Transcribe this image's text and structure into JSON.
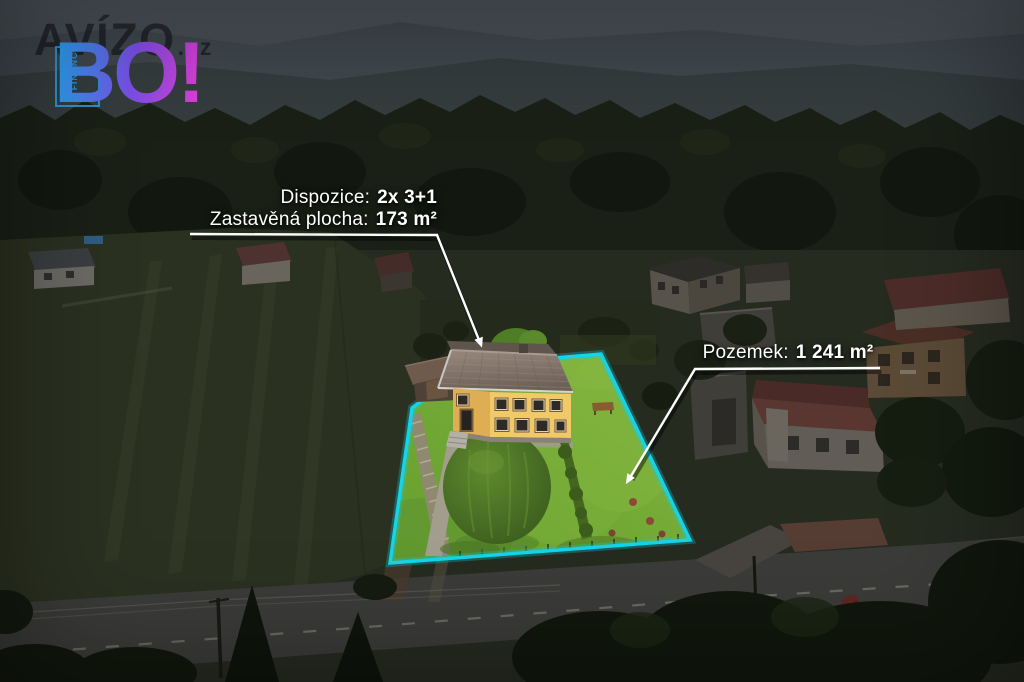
{
  "logo": {
    "brand_text": "AVÍZO",
    "brand_suffix": ".cz",
    "badge_text": "BO!",
    "tagline_line1": "REALITY",
    "tagline_line2": "& FINANCE"
  },
  "annotations": {
    "dispozice": {
      "label": "Dispozice:",
      "value": "2x 3+1"
    },
    "zastavena_plocha": {
      "label": "Zastavěná plocha:",
      "value": "173 m²"
    },
    "pozemek": {
      "label": "Pozemek:",
      "value": "1 241 m²"
    }
  },
  "colors": {
    "parcel_outline": "#17d3e9",
    "parcel_outline_glow": "rgba(0,214,238,0.28)",
    "callout_line": "#ffffff",
    "annotation_text": "#ffffff",
    "logo_blue": "#2d9ff2",
    "logo_purple": "#7a4fe8",
    "logo_magenta": "#d83fd8",
    "tagline_blue": "#2a9ae6",
    "grass_bright": "#74aa33",
    "house_wall_yellow": "#eec766",
    "house_roof_gray": "#837468"
  }
}
